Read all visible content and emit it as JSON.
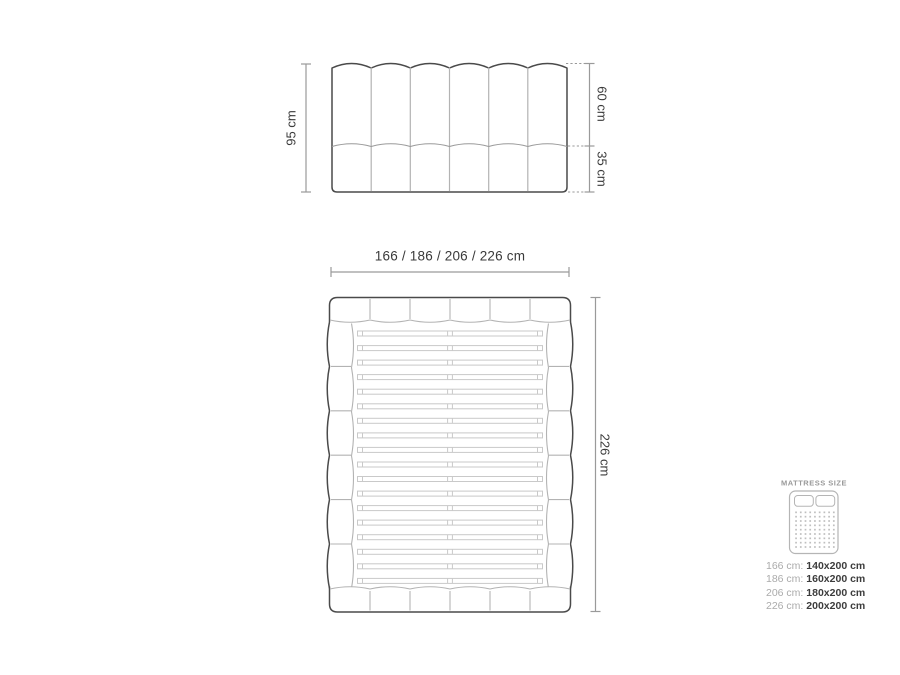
{
  "palette": {
    "outline": "#4a4a4a",
    "light_line": "#b3b3b3",
    "mid_line": "#999999",
    "dim_line": "#9a9a9a",
    "slat_line": "#c9c9c9",
    "text": "#3a3a3a",
    "muted_text": "#ababab",
    "icon_line": "#b5b5b5"
  },
  "headboard_view": {
    "height_label": "95 cm",
    "upper_label": "60 cm",
    "lower_label": "35 cm",
    "channels": 6
  },
  "top_view": {
    "width_label": "166 / 186 / 206 / 226 cm",
    "length_label": "226 cm",
    "slat_count": 18,
    "rail_segments": 6,
    "frame_segments": 6
  },
  "legend": {
    "title": "MATTRESS SIZE",
    "icon": "mattress-icon",
    "dot_cols": 9,
    "dot_rows": 9,
    "rows": [
      {
        "frame": "166 cm:",
        "mattress": "140x200 cm"
      },
      {
        "frame": "186 cm:",
        "mattress": "160x200 cm"
      },
      {
        "frame": "206 cm:",
        "mattress": "180x200 cm"
      },
      {
        "frame": "226 cm:",
        "mattress": "200x200 cm"
      }
    ]
  }
}
